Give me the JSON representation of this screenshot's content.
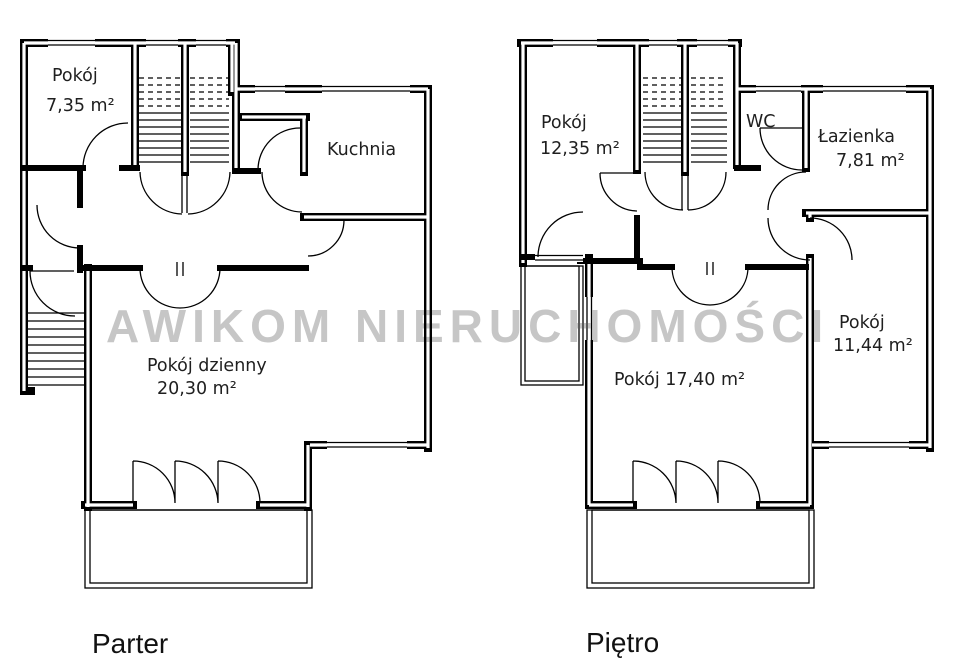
{
  "watermark": "AWIKOM NIERUCHOMOŚCI",
  "colors": {
    "wall": "#000000",
    "watermark_gray": "#c6c6c6",
    "label": "#1f1f1f",
    "background": "#ffffff"
  },
  "floors": [
    {
      "name": "Parter",
      "rooms": [
        {
          "id": "pokoj-735",
          "lines": [
            "Pokój",
            "7,35 m²"
          ]
        },
        {
          "id": "kuchnia",
          "lines": [
            "Kuchnia"
          ]
        },
        {
          "id": "pokoj-dzienny",
          "lines": [
            "Pokój dzienny",
            "20,30 m²"
          ]
        }
      ]
    },
    {
      "name": "Piętro",
      "rooms": [
        {
          "id": "pokoj-1235",
          "lines": [
            "Pokój",
            "12,35 m²"
          ]
        },
        {
          "id": "wc",
          "lines": [
            "WC"
          ]
        },
        {
          "id": "lazienka",
          "lines": [
            "Łazienka",
            "7,81 m²"
          ]
        },
        {
          "id": "pokoj-1144",
          "lines": [
            "Pokój",
            "11,44 m²"
          ]
        },
        {
          "id": "pokoj-1740",
          "lines": [
            "Pokój 17,40 m²"
          ]
        }
      ]
    }
  ]
}
